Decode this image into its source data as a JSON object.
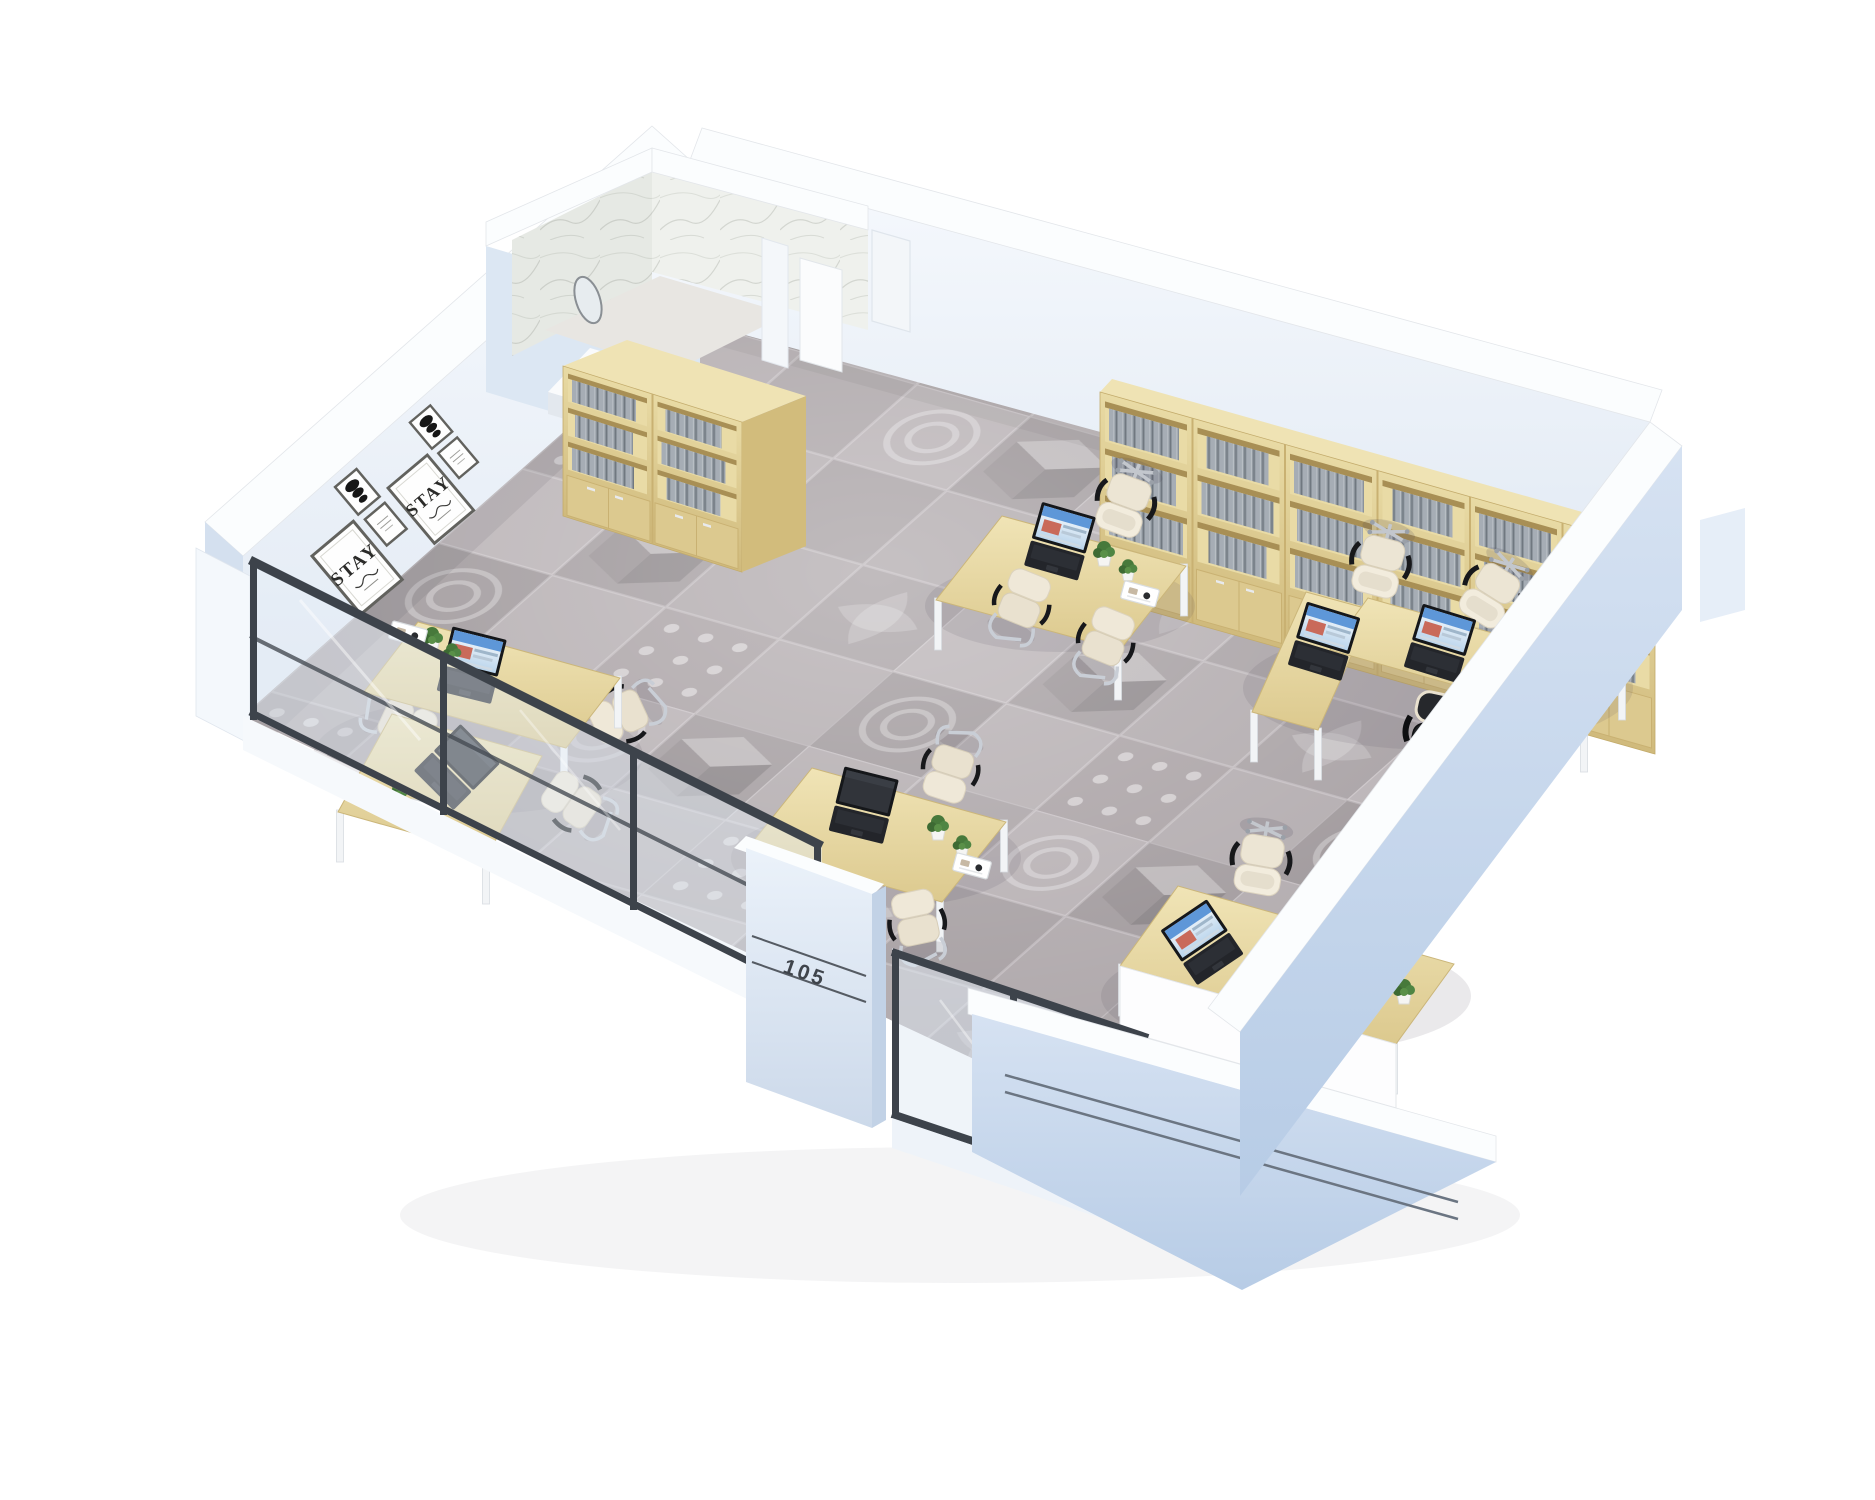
{
  "scene": {
    "description": "3D isometric cutaway render of a small office suite with patterned carpet, glass front partition, bookshelves and workstations",
    "room_number": "105",
    "poster_text": "STAY"
  },
  "palette": {
    "background": "#ffffff",
    "wall_top": "#fbfdfe",
    "wall_inner": "#eaf0f8",
    "wall_outer": "#c5d6ec",
    "floor_base": "#aba3a6",
    "wood_light": "#e9dcab",
    "wood_mid": "#d9c488",
    "wood_dark": "#c9b273",
    "books_gray": "#99a1a9",
    "glass_frame": "#3d434b",
    "glass_tint": "#e2ecf4",
    "chair_cream": "#eae2d0",
    "chair_black": "#1d1e20",
    "laptop_body": "#202125",
    "screen_blue": "#5e97d8",
    "plant_green": "#47793b",
    "marble": "#eff1ed"
  },
  "inventory": {
    "desks": 5,
    "chairs": 13,
    "laptops": 8,
    "bookcases": 2,
    "plants": 10,
    "desk_trays": 5,
    "wall_art_frames": 6,
    "glass_partitions": 2,
    "bathroom": 1
  }
}
